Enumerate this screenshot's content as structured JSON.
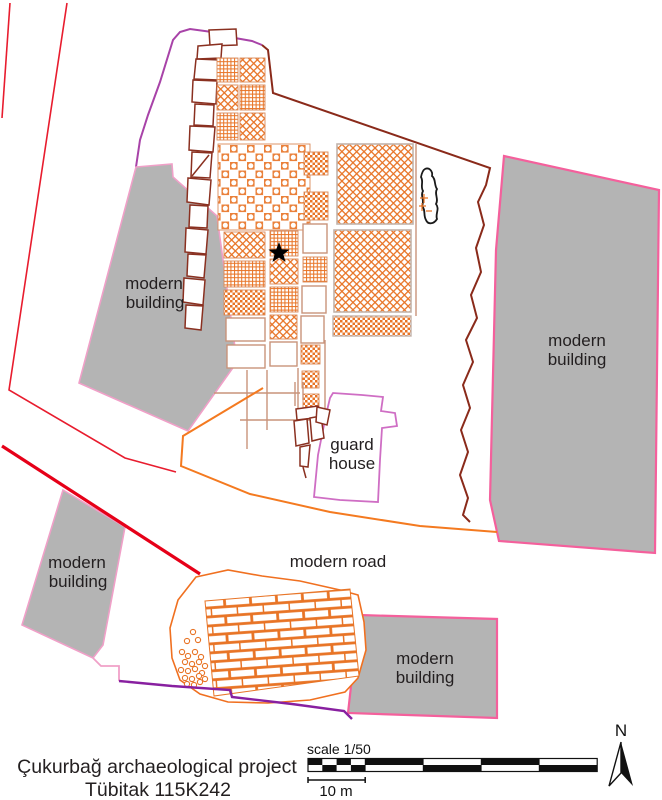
{
  "map": {
    "labels": [
      {
        "id": "building-a-line1",
        "text": "modern"
      },
      {
        "id": "building-a-line2",
        "text": "building"
      },
      {
        "id": "building-b-line1",
        "text": "modern"
      },
      {
        "id": "building-b-line2",
        "text": "building"
      },
      {
        "id": "building-c-line1",
        "text": "modern"
      },
      {
        "id": "building-c-line2",
        "text": "building"
      },
      {
        "id": "building-d-line1",
        "text": "modern"
      },
      {
        "id": "building-d-line2",
        "text": "building"
      },
      {
        "id": "guard-house-line1",
        "text": "guard"
      },
      {
        "id": "guard-house-line2",
        "text": "house"
      },
      {
        "id": "road",
        "text": "modern road"
      }
    ],
    "title_line1": "Çukurbağ archaeological project",
    "title_line2": "Tübitak 115K242",
    "scale_label": "scale 1/50",
    "scale_distance": "10 m",
    "north_label": "N",
    "colors": {
      "pattern_orange": "#e87426",
      "road_orange": "#f47a20",
      "trench_brown": "#8a3020",
      "boundary_brown": "#8a2a1a",
      "purple_top": "#a843a8",
      "purple_bottom": "#8820a0",
      "pink_strong": "#f4609c",
      "pink_light": "#f0a0c8",
      "guardhouse_orchid": "#cf6ec4",
      "red_thin": "#e81c2e",
      "red_thick": "#e60018",
      "building_gray": "#b4b4b4",
      "text": "#231f20"
    }
  }
}
